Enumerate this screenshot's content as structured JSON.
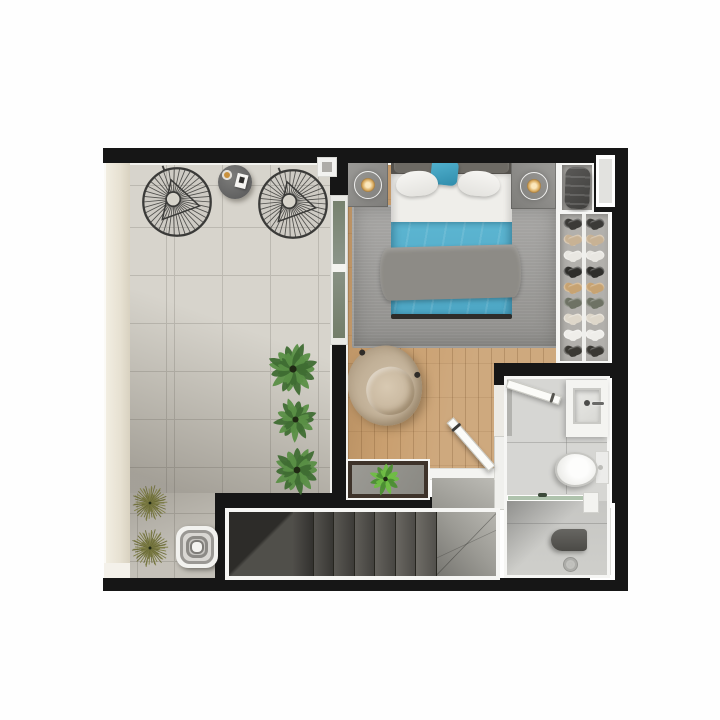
{
  "scene": {
    "kind": "residential-floor-plan-3d-render-top-view",
    "rooms": [
      {
        "name": "terrace",
        "items": [
          "wire-lounge-chair",
          "wire-lounge-chair",
          "round-side-table",
          "coffee-cup",
          "notebook",
          "potted-plant-large",
          "potted-plant-bushy",
          "potted-plant-spiky",
          "grass-plant",
          "grass-plant",
          "wicker-ottoman"
        ]
      },
      {
        "name": "bedroom",
        "items": [
          "double-bed",
          "headboard",
          "white-pillow",
          "white-pillow",
          "teal-accent-pillow",
          "teal-duvet",
          "gray-throw-blanket",
          "nightstand",
          "nightstand",
          "table-lamp",
          "table-lamp",
          "area-rug",
          "armchair",
          "sliding-glass-door",
          "console-shelf",
          "console-plant"
        ]
      },
      {
        "name": "closet-nook",
        "items": [
          "duffel-bag",
          "shoe-rack",
          "window"
        ]
      },
      {
        "name": "bathroom",
        "items": [
          "entry-door",
          "vanity-sink",
          "faucet",
          "toilet",
          "glass-shower-partition",
          "shower-bench",
          "floor-drain",
          "window"
        ]
      },
      {
        "name": "stair-hall",
        "items": [
          "staircase",
          "winder-steps",
          "upper-landing",
          "bedroom-entry-door"
        ]
      }
    ]
  },
  "palette": {
    "wall": "#161616",
    "trim": "#f6f6f4",
    "terrace_tile": "#d7d4cc",
    "tile_line": "#bcb9b1",
    "exterior_ledge": "#e7e1d2",
    "wood_floor": "#c99f6f",
    "area_rug": "#9b9a97",
    "linen_white": "#efeeea",
    "duvet_teal": "#58b1ce",
    "accent_teal": "#3d9cbd",
    "throw_gray": "#8d8b86",
    "headboard_gray": "#55524d",
    "nightstand_gray": "#8f8e8b",
    "lamp_glow": "#f3d9a6",
    "armchair_beige": "#c2b198",
    "wire_chair_dark": "#3a3a38",
    "side_table_gray": "#6e6e6c",
    "plant_green_dark": "#3f6d33",
    "plant_green_light": "#5a8f46",
    "console_plant_1": "#6fbd45",
    "console_plant_2": "#4c8f33",
    "plant_olive": "#7d7d44",
    "plant_olive_2": "#6b6b38",
    "ottoman_white": "#f2f2ef",
    "closet_shelf": "#b2b0ac",
    "bag_charcoal": "#4e4d4b",
    "bathroom_floor": "#d6d6d3",
    "porcelain_white": "#fafaf8",
    "shower_glass_green": "#a8bfa6",
    "shower_bench_dark": "#55544f",
    "stair_dark": "#403f3b",
    "stair_light": "#8f8e8a",
    "landing_gray": "#a4a39e",
    "window_light": "#e4e4e1",
    "sliding_glass": "#7f8a78",
    "console_frame_wood": "#3e332a"
  },
  "closet": {
    "shoe_row_colors": [
      "#3b3a37",
      "#c8b294",
      "#e9e7e2",
      "#2f2e2b",
      "#c7a372",
      "#6e7264",
      "#ded7ca",
      "#efeeea",
      "#3a3833"
    ]
  },
  "stairs": {
    "tread_count": 7
  }
}
